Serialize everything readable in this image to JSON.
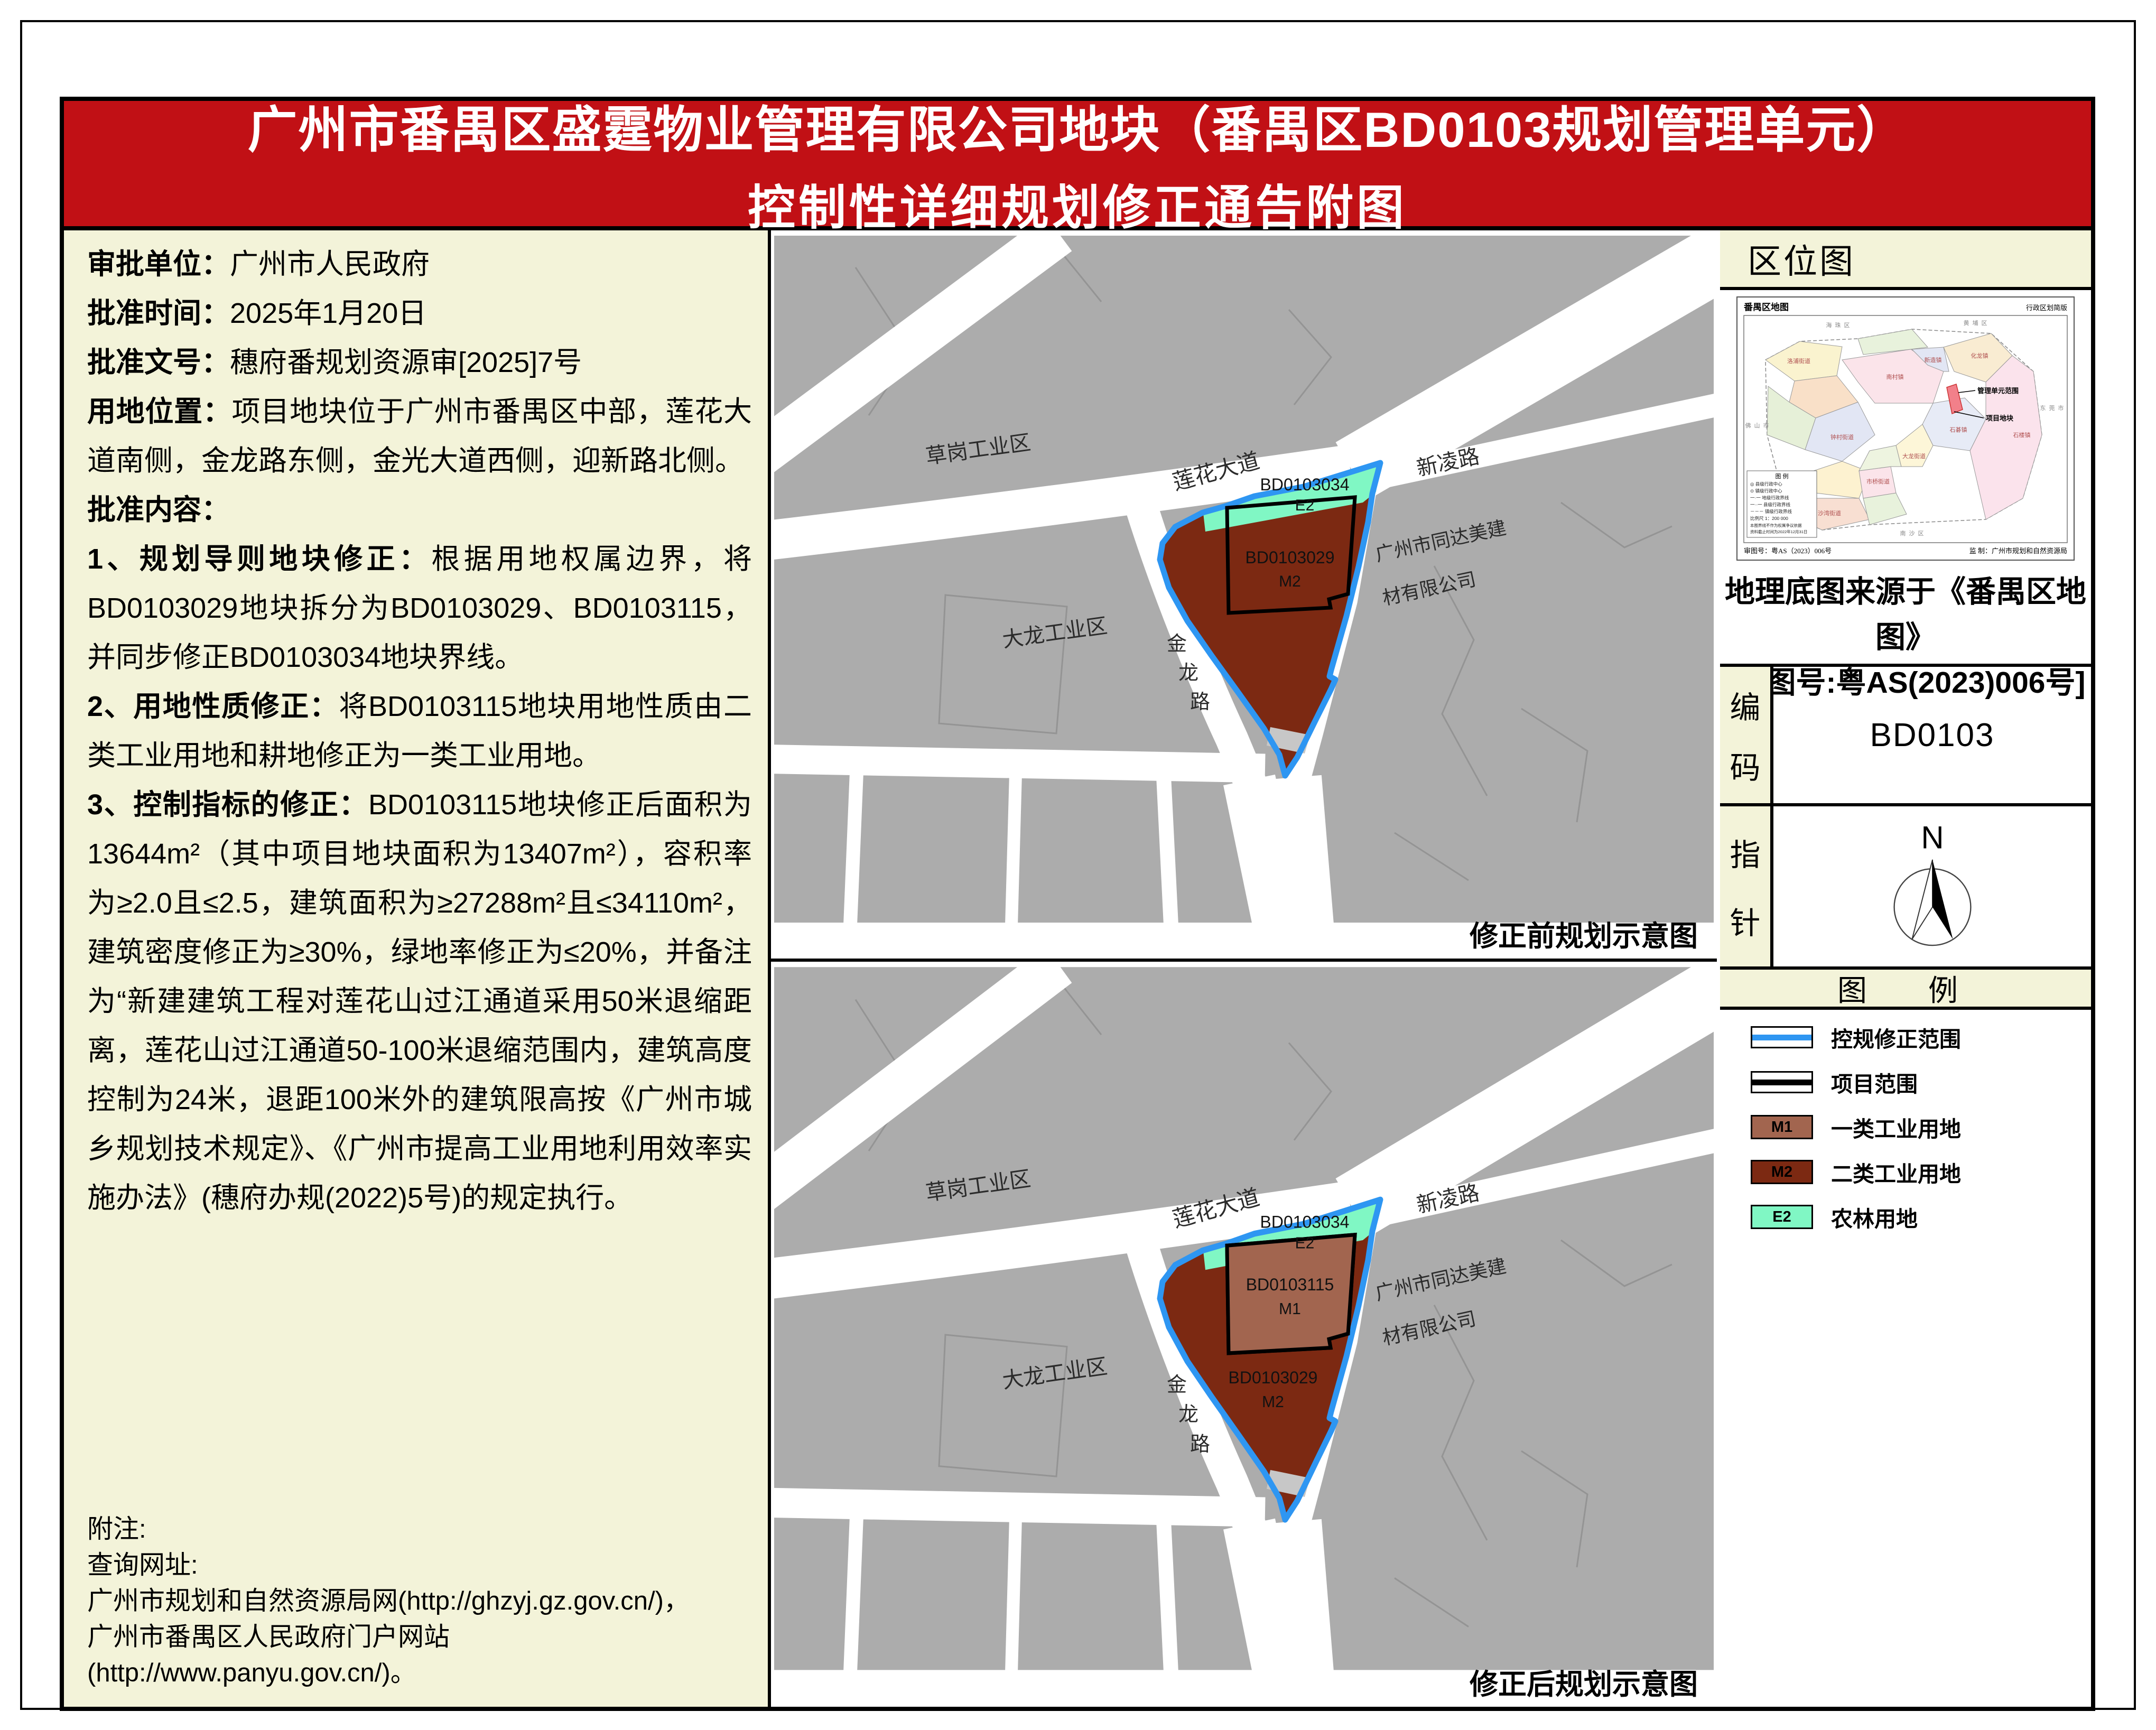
{
  "title": {
    "line1": "广州市番禺区盛霆物业管理有限公司地块（番禺区BD0103规划管理单元）",
    "line2": "控制性详细规划修正通告附图"
  },
  "info": {
    "fields": [
      {
        "label": "审批单位：",
        "text": "广州市人民政府"
      },
      {
        "label": "批准时间：",
        "text": "2025年1月20日"
      },
      {
        "label": "批准文号：",
        "text": "穗府番规划资源审[2025]7号"
      },
      {
        "label": "用地位置：",
        "text": "项目地块位于广州市番禺区中部，莲花大道南侧，金龙路东侧，金光大道西侧，迎新路北侧。"
      },
      {
        "label": "批准内容：",
        "text": ""
      }
    ],
    "items": [
      {
        "label": "1、规划导则地块修正：",
        "text": "根据用地权属边界，将BD0103029地块拆分为BD0103029、BD0103115，并同步修正BD0103034地块界线。"
      },
      {
        "label": "2、用地性质修正：",
        "text": "将BD0103115地块用地性质由二类工业用地和耕地修正为一类工业用地。"
      },
      {
        "label": "3、控制指标的修正：",
        "text": "BD0103115地块修正后面积为13644m²（其中项目地块面积为13407m²），容积率为≥2.0且≤2.5，建筑面积为≥27288m²且≤34110m²，建筑密度修正为≥30%，绿地率修正为≤20%，并备注为“新建建筑工程对莲花山过江通道采用50米退缩距离，莲花山过江通道50-100米退缩范围内，建筑高度控制为24米，退距100米外的建筑限高按《广州市城乡规划技术规定》、《广州市提高工业用地利用效率实施办法》(穗府办规(2022)5号)的规定执行。"
      }
    ],
    "notes": [
      "附注:",
      "查询网址:",
      "广州市规划和自然资源局网(http://ghzyj.gz.gov.cn/)，",
      "广州市番禺区人民政府门户网站(http://www.panyu.gov.cn/)。"
    ]
  },
  "maps": {
    "before_caption": "修正前规划示意图",
    "after_caption": "修正后规划示意图",
    "labels": {
      "caogang": "草岗工业区",
      "dalong": "大龙工业区",
      "lianhua": "莲花大道",
      "xinling": "新凌路",
      "jin": "金",
      "long": "龙",
      "lu": "路",
      "company1": "广州市同达美建",
      "company2": "材有限公司"
    },
    "parcels": {
      "bd34": "BD0103034",
      "e2": "E2",
      "bd29": "BD0103029",
      "m2": "M2",
      "bd115": "BD0103115",
      "m1": "M1"
    }
  },
  "sidebar": {
    "section_title": "区位图",
    "inset": {
      "title": "番禺区地图",
      "subtitle": "行政区划简版",
      "callout_unit": "管理单元范围",
      "callout_site": "项目地块",
      "legend_heading": "图 例",
      "legend_rows": [
        "◎ 县级行政中心",
        "⊙ 镇级行政中心",
        "一·一 地级行政界线",
        "一··一 县级行政界线",
        "－－－ 镇级行政界线",
        "比例尺 1：200 000",
        "本图界线不作为权属争议依据",
        "资料截止时间为2022年12月31日"
      ],
      "approval": "审图号：粤AS（2023）006号",
      "producer": "监 制：广州市规划和自然资源局",
      "context": [
        "海珠区",
        "黄埔区",
        "东莞市",
        "南沙区",
        "佛山市"
      ],
      "districts": [
        "洛浦街道",
        "南村镇",
        "化龙镇",
        "新造镇",
        "石楼镇",
        "石碁镇",
        "大龙街道",
        "市桥街道",
        "沙湾街道",
        "钟村街道"
      ]
    },
    "source_line1": "地理底图来源于《番禺区地图》",
    "source_line2": "[审图号:粤AS(2023)006号]",
    "code": {
      "label_chars": [
        "编",
        "码"
      ],
      "value": "BD0103"
    },
    "compass": {
      "label_chars": [
        "指",
        "针"
      ],
      "north": "N"
    },
    "legend": {
      "title": "图　例",
      "items": [
        {
          "label": "控规修正范围",
          "type": "line",
          "color": "#2E96F2"
        },
        {
          "label": "项目范围",
          "type": "line",
          "color": "#000000"
        },
        {
          "label": "一类工业用地",
          "code": "M1",
          "color": "#A2654F"
        },
        {
          "label": "二类工业用地",
          "code": "M2",
          "color": "#7C2912"
        },
        {
          "label": "农林用地",
          "code": "E2",
          "color": "#80F7C4"
        }
      ]
    }
  },
  "colors": {
    "banner_red": "#C11015",
    "cream": "#F3F3D9",
    "map_gray": "#ACACAC",
    "m1": "#A2654F",
    "m2": "#7C2912",
    "e2": "#80F7C4",
    "boundary_blue": "#2E96F2"
  }
}
